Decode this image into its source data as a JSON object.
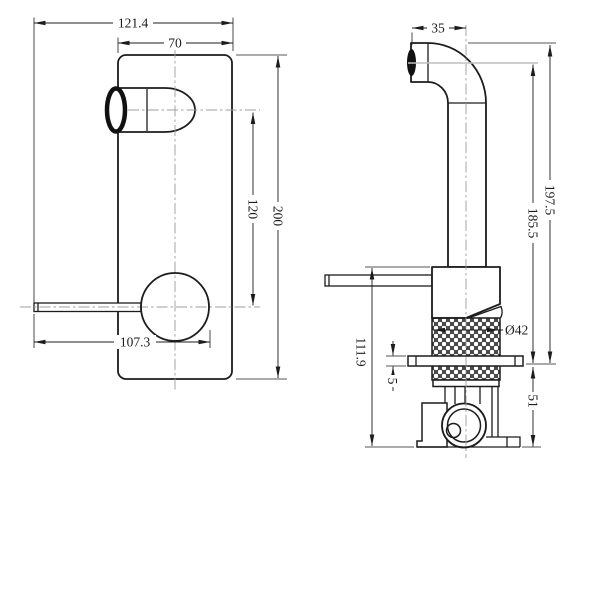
{
  "drawing": {
    "type": "technical-dimension-drawing",
    "subject": "wall-mounted basin mixer tap, front elevation and side elevation",
    "units": "mm",
    "colors": {
      "line": "#1c1c1c",
      "centerline": "#9c9c9c",
      "reference_line": "#bfbfbf",
      "background": "#ffffff"
    },
    "front_view": {
      "dimensions": {
        "overall_width": "121.4",
        "plate_width": "70",
        "plate_height": "200",
        "spout_to_handle_center": "120",
        "lever_reach": "107.3"
      }
    },
    "side_view": {
      "dimensions": {
        "spout_tip_to_pipe_center": "35",
        "spout_top_to_wall": "197.5",
        "spout_outlet_to_wall": "185.5",
        "handle_top_to_body_bottom": "111.9",
        "plate_thickness": "5",
        "concealed_depth": "51",
        "valve_diameter": "Ø42"
      }
    }
  }
}
